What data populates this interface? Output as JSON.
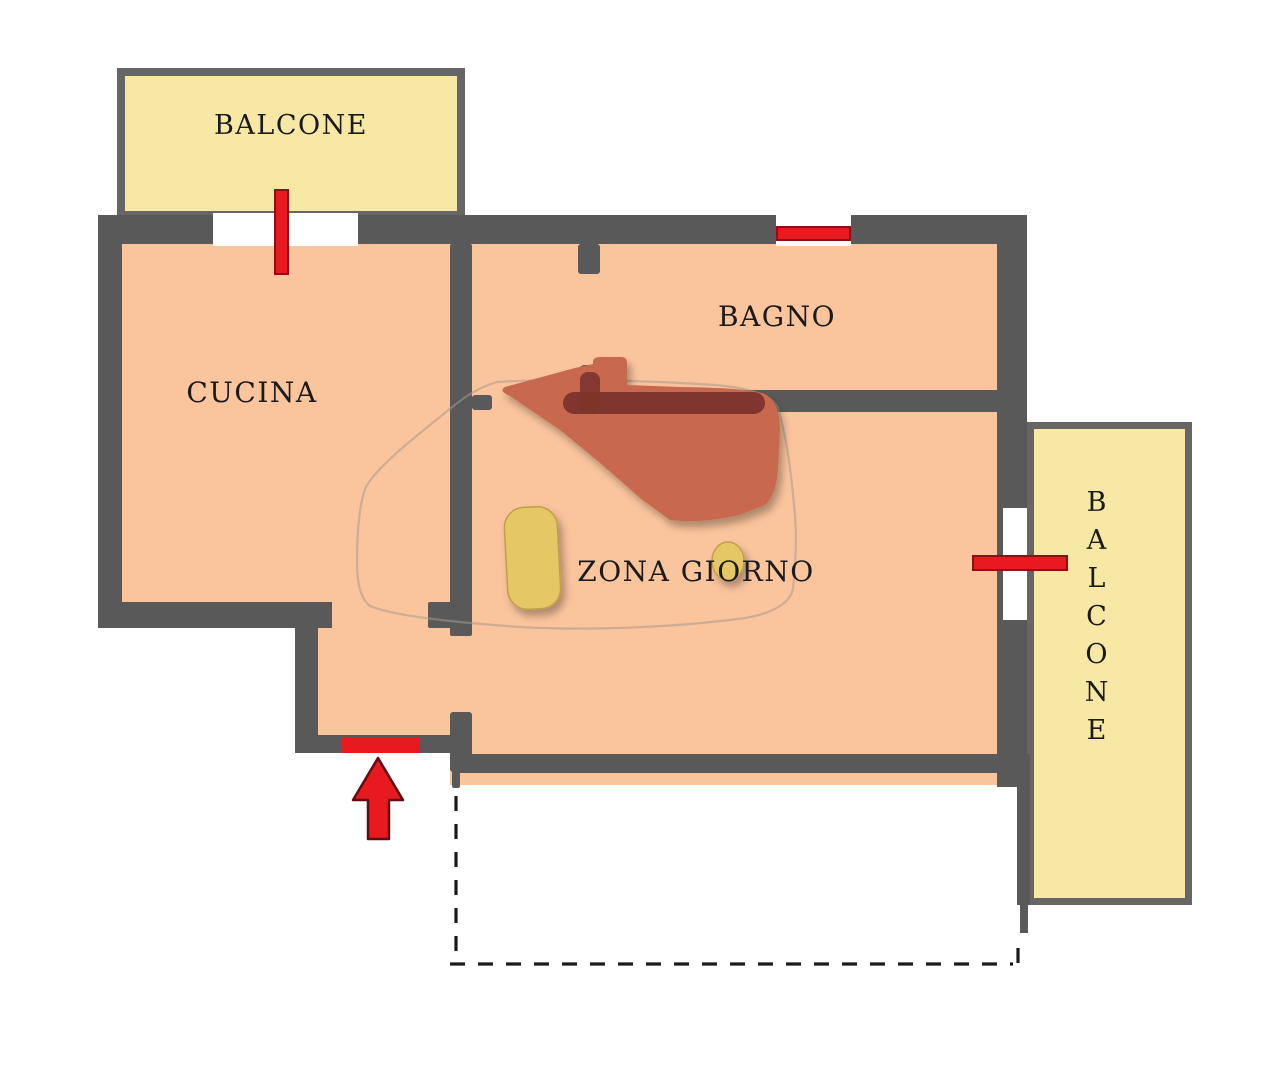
{
  "colors": {
    "wall": "#595959",
    "balcony_border": "#666666",
    "room_fill": "#fac49d",
    "balcony_fill": "#f8e8a5",
    "accent_red": "#e8191f",
    "red_dark": "#8c1016",
    "arrow_border": "#5f0d12",
    "blob": "#c8694f",
    "blob_dark": "#7c342c",
    "furniture_yellow": "#e5c765",
    "furniture_border": "#bfa04a",
    "outline": "#a89a8d",
    "line": "#1a1a1a",
    "text": "#1b1b1b",
    "bg": "#ffffff"
  },
  "labels": {
    "balcony_top": "BALCONE",
    "kitchen": "CUCINA",
    "bathroom": "BAGNO",
    "living_area": "ZONA GIORNO",
    "balcony_right": "BALCONE"
  }
}
